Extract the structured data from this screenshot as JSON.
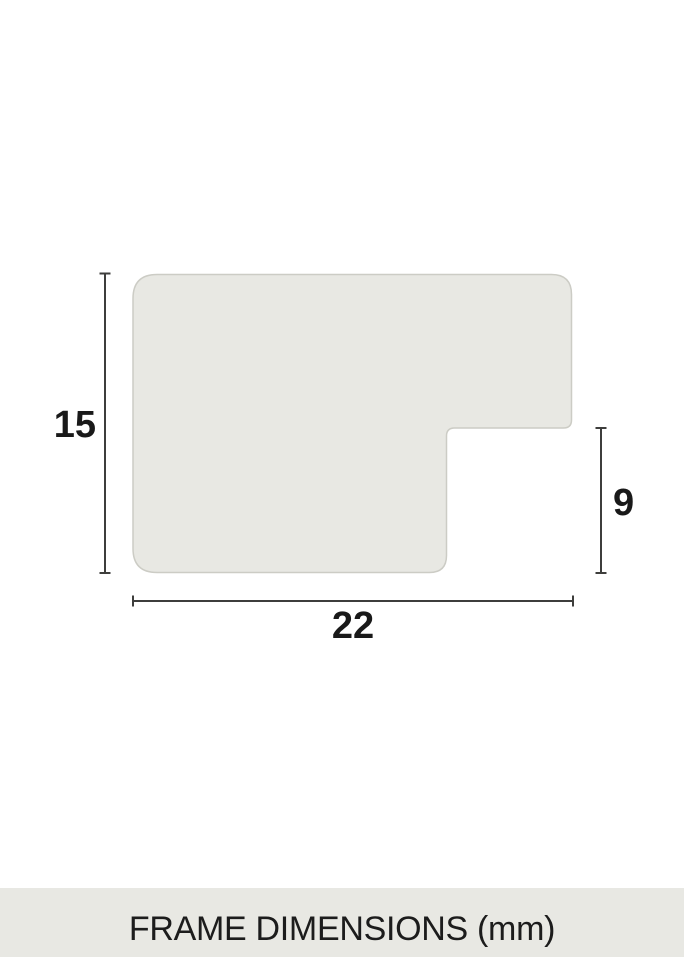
{
  "page": {
    "background": "#ffffff"
  },
  "diagram": {
    "profile": {
      "fill": "#e8e8e3",
      "stroke": "#ccccc5"
    },
    "dimension_line_color": "#3e3e3c",
    "label_color": "#191919",
    "dimensions": {
      "height": {
        "value": "15"
      },
      "notch": {
        "value": "9"
      },
      "width": {
        "value": "22"
      }
    }
  },
  "footer": {
    "label": "FRAME DIMENSIONS (mm)",
    "background": "#e8e8e3",
    "text_color": "#1c1c1c"
  }
}
